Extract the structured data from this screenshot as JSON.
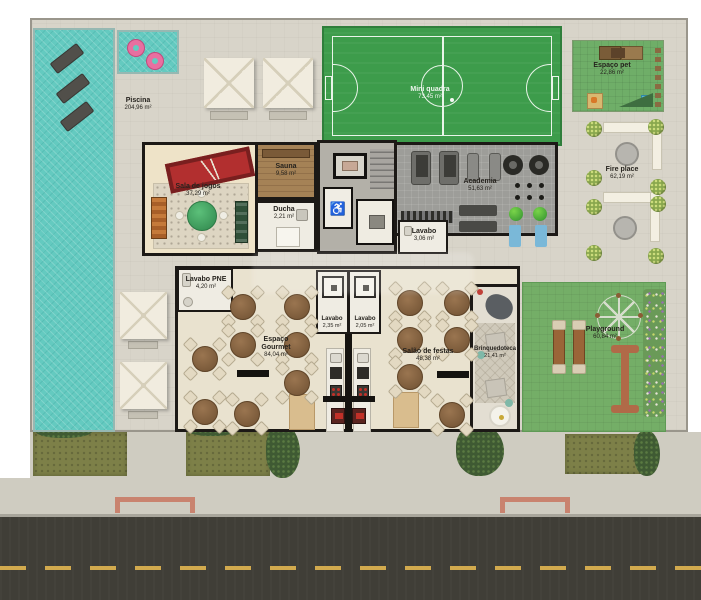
{
  "rooms": {
    "piscina": {
      "name": "Piscina",
      "area": "204,96 m²"
    },
    "mini_quadra": {
      "name": "Mini quadra",
      "area": "73,45 m²"
    },
    "espaco_pet": {
      "name": "Espaço pet",
      "area": "22,86 m²"
    },
    "fire_place": {
      "name": "Fire place",
      "area": "62,19 m²"
    },
    "sala_de_jogos": {
      "name": "Sala de jogos",
      "area": "37,29 m²"
    },
    "sauna": {
      "name": "Sauna",
      "area": "9,58 m²"
    },
    "ducha": {
      "name": "Ducha",
      "area": "2,21 m²"
    },
    "academia": {
      "name": "Academia",
      "area": "51,63 m²"
    },
    "lavabo_academia": {
      "name": "Lavabo",
      "area": "3,06 m²"
    },
    "lavabo_pne": {
      "name": "Lavabo PNE",
      "area": "4,20 m²"
    },
    "espaco_gourmet": {
      "name": "Espaço Gourmet",
      "area": "84,04 m²"
    },
    "lavabo_esq": {
      "name": "Lavabo",
      "area": "2,35 m²"
    },
    "lavabo_dir": {
      "name": "Lavabo",
      "area": "2,05 m²"
    },
    "salao_de_festas": {
      "name": "Salão de festas",
      "area": "48,38 m²"
    },
    "brinquedoteca": {
      "name": "Brinquedoteca",
      "area": "21,41 m²"
    },
    "playground": {
      "name": "Playground",
      "area": "60,84 m²"
    }
  },
  "icons": {
    "wheelchair": "♿"
  },
  "colors": {
    "pool": "#64cac0",
    "field_green": "#3d9c4b",
    "lawn_green": "#74ae67",
    "street": "#403e37",
    "accent_salmon": "#c9836f",
    "wall": "#1c1916"
  }
}
